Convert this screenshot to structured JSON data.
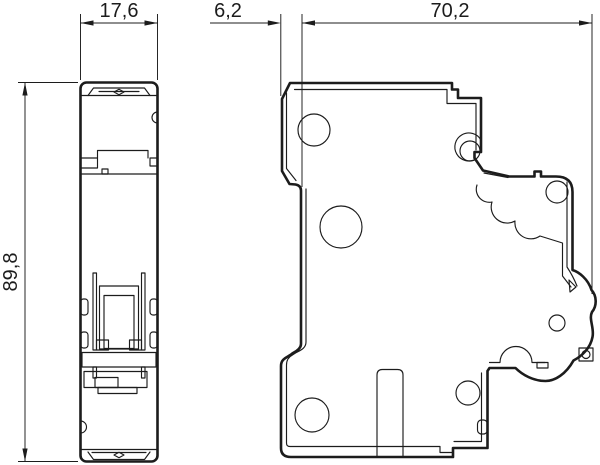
{
  "drawing": {
    "type": "technical-dimensional-drawing",
    "views": {
      "front_label": "front-view",
      "side_label": "side-view"
    },
    "dimensions": {
      "front_width_mm": "17,6",
      "flange_offset_mm": "6,2",
      "body_depth_mm": "70,2",
      "body_height_mm": "89,8"
    },
    "colors": {
      "line": "#1c1c1c",
      "background": "#ffffff"
    }
  }
}
